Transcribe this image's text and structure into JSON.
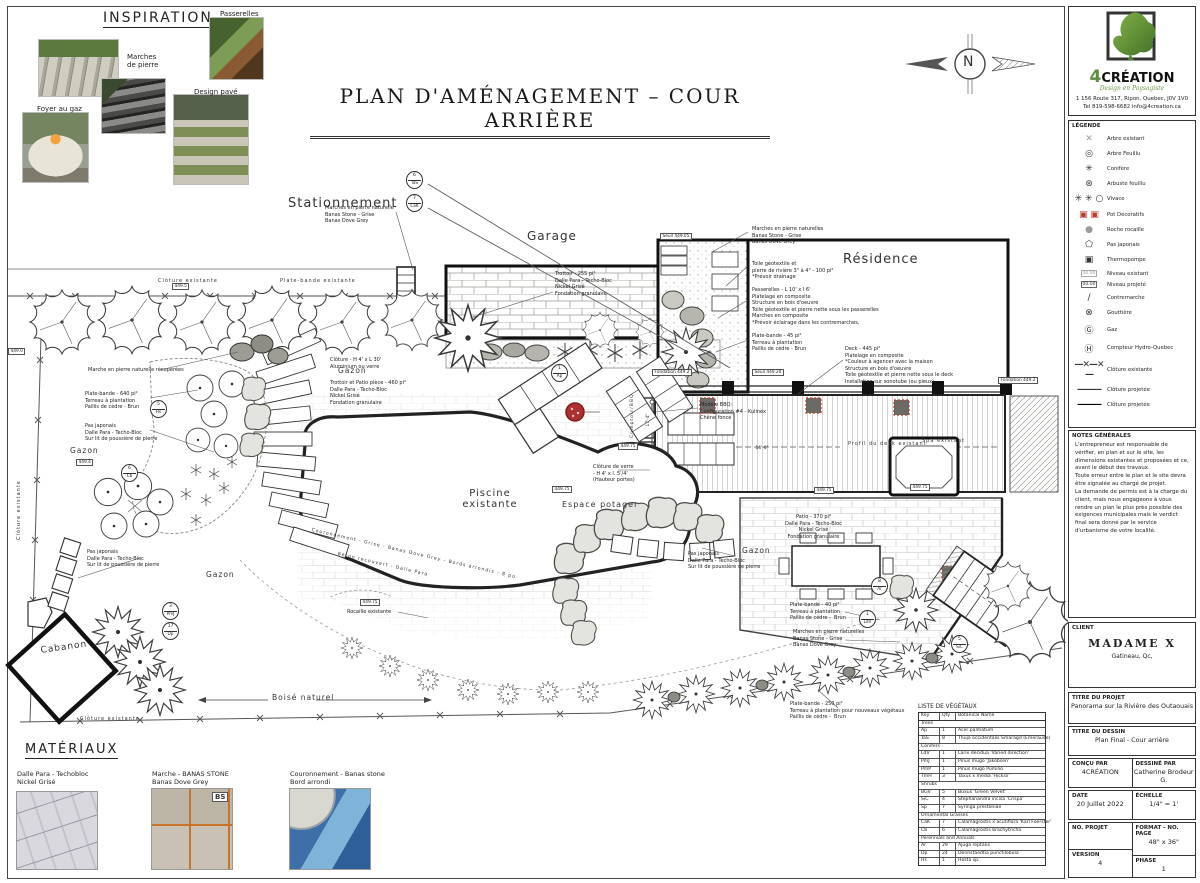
{
  "sheet": {
    "title": "PLAN D'AMÉNAGEMENT – COUR ARRIÈRE",
    "north_letter": "N"
  },
  "inspiration": {
    "title": "INSPIRATION",
    "labels": [
      {
        "t": "Passerelles",
        "x": 220,
        "y": 10
      },
      {
        "t": "Marches\nde pierre",
        "x": 127,
        "y": 53
      },
      {
        "t": "Foyer au gaz",
        "x": 37,
        "y": 105
      },
      {
        "t": "Design pavé",
        "x": 194,
        "y": 88
      }
    ]
  },
  "materials": {
    "title": "MATÉRIAUX",
    "badge": "BS",
    "items": [
      {
        "t": "Dalle Para - Techobloc\nNickel Grisé",
        "x": 17,
        "y": 770
      },
      {
        "t": "Marche - BANAS STONE\nBanas Dove Grey",
        "x": 152,
        "y": 770
      },
      {
        "t": "Couronnement - Banas stone\nBord arrondi",
        "x": 290,
        "y": 770
      }
    ]
  },
  "plan": {
    "labels": [
      {
        "t": "Stationnement",
        "x": 288,
        "y": 196,
        "s": 13
      },
      {
        "t": "Garage",
        "x": 527,
        "y": 229,
        "s": 12
      },
      {
        "t": "Résidence",
        "x": 843,
        "y": 252,
        "s": 13
      },
      {
        "t": "Piscine\nexistante",
        "x": 450,
        "y": 488,
        "s": 10,
        "w": 80,
        "al": "center"
      },
      {
        "t": "Espace potager",
        "x": 562,
        "y": 500,
        "s": 8
      },
      {
        "t": "Cabanon",
        "x": 40,
        "y": 646,
        "s": 9,
        "r": -8
      },
      {
        "t": "Gazon",
        "x": 70,
        "y": 446,
        "s": 7.5
      },
      {
        "t": "Gazon",
        "x": 338,
        "y": 366,
        "s": 7.5
      },
      {
        "t": "Gazon",
        "x": 206,
        "y": 570,
        "s": 7.5
      },
      {
        "t": "Gazon",
        "x": 742,
        "y": 546,
        "s": 7.5
      },
      {
        "t": "Boisé naturel",
        "x": 272,
        "y": 693,
        "s": 7.5
      },
      {
        "t": "N",
        "x": 963,
        "y": 54,
        "s": 14,
        "cls": "serif"
      },
      {
        "t": "Clôture existante",
        "x": 158,
        "y": 278,
        "s": 5
      },
      {
        "t": "Plate-bande existante",
        "x": 280,
        "y": 278,
        "s": 5
      },
      {
        "t": "Clôture existante",
        "x": 16,
        "y": 540,
        "s": 5,
        "r": -90
      },
      {
        "t": "Clôture existante",
        "x": 80,
        "y": 716,
        "s": 5
      },
      {
        "t": "Comptoir/BBQ",
        "x": 630,
        "y": 438,
        "s": 4.6,
        "r": -90
      },
      {
        "t": "Spa existant",
        "x": 922,
        "y": 438,
        "s": 5
      },
      {
        "t": "Profil du deck existant",
        "x": 848,
        "y": 441,
        "s": 5
      },
      {
        "t": "Couronnement - Grise - Banas Dove Grey - Bords arrondis - 8 po",
        "x": 312,
        "y": 528,
        "s": 4.6,
        "r": 13
      },
      {
        "t": "Béton recouvert - Dalle Para",
        "x": 338,
        "y": 552,
        "s": 4.6,
        "r": 13
      }
    ],
    "notes": [
      {
        "t": "Marches en pierre naturelle\nBanas Stone - Grise\nBanas Dove Grey",
        "x": 325,
        "y": 205
      },
      {
        "t": "Marches en pierre naturelles\nBanas Stone - Grise\nBanas Dove Grey",
        "x": 752,
        "y": 226
      },
      {
        "t": "Trottoir - 255 pi²\nDalle Para - Techo-Bloc\nNickel Grisé\nFondation granulaire",
        "x": 555,
        "y": 271
      },
      {
        "t": "Toile géotextile et\npierre de rivière 3\" à 4\" - 100 pi²\n*Prévoir drainage",
        "x": 752,
        "y": 261
      },
      {
        "t": "Passerelles - L 10' x l 6'\nPlatelage en composite\nStructure en bois d'oeuvre\nToile géotextile et pierre nette sous les passerelles\nMarches en composite\n*Prévoir éclairage dans les contremarches,",
        "x": 752,
        "y": 287
      },
      {
        "t": "Plate-bande - 45 pi²\nTerreau à plantation\nPaillis de cèdre - Brun",
        "x": 752,
        "y": 333
      },
      {
        "t": "Deck - 445 pi²\nPlatelage en composite\n*Couleur à agencer avec la maison\nStructure en bois d'oeuvre\nToile géotextile et pierre nette sous le deck\nInstallation sur sonotube (ou pieux)",
        "x": 845,
        "y": 346
      },
      {
        "t": "Marche en pierre naturelle récupérées",
        "x": 88,
        "y": 367
      },
      {
        "t": "Plate-bande - 640 pi²\nTerreau à plantation\nPaillis de cèdre - Brun",
        "x": 85,
        "y": 391
      },
      {
        "t": "Pas japonais\nDalle Para - Techo-Bloc\nSur lit de poussière de pierre",
        "x": 85,
        "y": 423
      },
      {
        "t": "Clôture - H 4' x L 30'\nAluminium ou verre",
        "x": 330,
        "y": 357
      },
      {
        "t": "Trottoir et Patio pièce - 460 pi²\nDalle Para - Techo-Bloc\nNickel Grisé\nFondation granulaire",
        "x": 330,
        "y": 380
      },
      {
        "t": "Clôture de verre\n- H 4' x l. 5'/4'\n(Hauteur portes)",
        "x": 593,
        "y": 464
      },
      {
        "t": "Modèle BBQ:\nConfiguration #4 - Kulinex\nChêne foncé",
        "x": 700,
        "y": 402
      },
      {
        "t": "Patio - 370 pi²\nDalle Para - Techo-Bloc\nNickel Grisé\nFondation granulaire",
        "x": 785,
        "y": 514,
        "al": "center"
      },
      {
        "t": "Pas japonais\nDalle Para - Techo-Bloc\nSur lit de poussière de pierre",
        "x": 688,
        "y": 551
      },
      {
        "t": "Pas japonais\nDalle Para - Techo-Bloc\nSur lit de poussière de pierre",
        "x": 87,
        "y": 549
      },
      {
        "t": "Plate-bande - 40 pi²\nTerreau à plantation\nPaillis de cèdre -  Brun",
        "x": 790,
        "y": 602
      },
      {
        "t": "Marches en pierre naturelles\nBanas Stone - Grise\nBanas Dove Grey",
        "x": 793,
        "y": 629
      },
      {
        "t": "Plate-bande - 250 pi²\nTerreau à plantation pour nouveaux végétaux\nPaillis de cèdre -  Brun",
        "x": 790,
        "y": 701
      },
      {
        "t": "Rocaille existante",
        "x": 347,
        "y": 609
      }
    ],
    "markers": [
      {
        "t": "449.5",
        "x": 172,
        "y": 283
      },
      {
        "t": "449.0",
        "x": 8,
        "y": 348
      },
      {
        "t": "449.4",
        "x": 76,
        "y": 459
      },
      {
        "t": "449.75",
        "x": 360,
        "y": 599
      },
      {
        "t": "Seuil 449.05",
        "x": 660,
        "y": 233
      },
      {
        "t": "Fondation 449.2",
        "x": 652,
        "y": 369
      },
      {
        "t": "Seuil 449.20",
        "x": 752,
        "y": 369
      },
      {
        "t": "Fondation 449.2",
        "x": 998,
        "y": 377
      },
      {
        "t": "449.75",
        "x": 618,
        "y": 443
      },
      {
        "t": "449.75",
        "x": 814,
        "y": 487
      },
      {
        "t": "449.75",
        "x": 910,
        "y": 484
      },
      {
        "t": "449.75",
        "x": 552,
        "y": 486
      },
      {
        "t": "17'-4\"",
        "x": 646,
        "y": 428,
        "r": -90,
        "cls": "nb"
      },
      {
        "t": "14'-6\"",
        "x": 754,
        "y": 446,
        "cls": "nb"
      }
    ],
    "callouts": [
      {
        "qty": "6",
        "key": "TaS",
        "x": 406,
        "y": 171
      },
      {
        "qty": "7",
        "key": "CaK",
        "x": 406,
        "y": 194
      },
      {
        "qty": "5",
        "key": "Hs",
        "x": 150,
        "y": 400
      },
      {
        "qty": "6",
        "key": "Cb",
        "x": 121,
        "y": 464
      },
      {
        "qty": "3",
        "key": "PmJ",
        "x": 162,
        "y": 602
      },
      {
        "qty": "17",
        "key": "Dp",
        "x": 162,
        "y": 622
      },
      {
        "qty": "1",
        "key": "Ap",
        "x": 551,
        "y": 364
      },
      {
        "qty": "8",
        "key": "Ar",
        "x": 871,
        "y": 577
      },
      {
        "qty": "1",
        "key": "LdV",
        "x": 859,
        "y": 610
      },
      {
        "qty": "5",
        "key": "SiC",
        "x": 951,
        "y": 635
      }
    ]
  },
  "veg_list": {
    "title": "LISTE DE VÉGÉTAUX",
    "headers": {
      "key": "Key",
      "qty": "Qty",
      "name": "Botanical Name"
    },
    "rows": [
      {
        "cls": "sec",
        "key": "Trees",
        "qty": "",
        "name": ""
      },
      {
        "key": "Ap",
        "qty": "1",
        "name": "Acer palmatum"
      },
      {
        "key": "TaS",
        "qty": "8",
        "name": "Thuja occidentalis Smaragd (Emeraude)"
      },
      {
        "cls": "sec",
        "key": "Conifers",
        "qty": "",
        "name": ""
      },
      {
        "key": "LdV",
        "qty": "1",
        "name": "Larix decidua 'Varied direction'"
      },
      {
        "key": "PmJ",
        "qty": "1",
        "name": "Pinus mugo 'Jakobsen'"
      },
      {
        "key": "PmP",
        "qty": "1",
        "name": "Pinus mugo Pumilio"
      },
      {
        "key": "TmH",
        "qty": "3",
        "name": "Taxus x media 'Hicksii'"
      },
      {
        "cls": "sec",
        "key": "Shrubs",
        "qty": "",
        "name": ""
      },
      {
        "key": "BGV",
        "qty": "5",
        "name": "Buxus 'Green Velvet'"
      },
      {
        "key": "SiC",
        "qty": "4",
        "name": "Stephanandra incisa 'Crispa'"
      },
      {
        "key": "Sp",
        "qty": "7",
        "name": "Syringa prestoniae"
      },
      {
        "cls": "sec",
        "key": "Ornamental Grasses",
        "qty": "",
        "name": ""
      },
      {
        "key": "CaK",
        "qty": "7",
        "name": "Calamagrostis x acutiflora 'Karl Foerster'"
      },
      {
        "key": "Cb",
        "qty": "6",
        "name": "Calamagrostis brachytricha"
      },
      {
        "cls": "sec",
        "key": "Perennials and Annuals",
        "qty": "",
        "name": ""
      },
      {
        "key": "Ar",
        "qty": "29",
        "name": "Ajuga reptans"
      },
      {
        "key": "Dp",
        "qty": "24",
        "name": "Dennstaedtia punctilobula"
      },
      {
        "key": "Hs",
        "qty": "1",
        "name": "Hosta sp."
      }
    ]
  },
  "sidebar": {
    "logo": {
      "brand_4": "4",
      "brand_rest": "CRÉATION",
      "tagline": "Design en Paysagiste",
      "addr1": "1 156 Route 317, Ripon, Quebec, J0V 1V0",
      "addr2": "Tel 819-598-6682  info@4creation.ca"
    },
    "legend": {
      "title": "LÉGENDE",
      "items": [
        {
          "glyph": "✕",
          "label": "Arbre existant",
          "cls": "gray"
        },
        {
          "glyph": "◎",
          "label": "Arbre Feuillu"
        },
        {
          "glyph": "✳",
          "label": "Conifère"
        },
        {
          "glyph": "⊛",
          "label": "Arbuste feuillu"
        },
        {
          "glyph": "✳ ✳ ○",
          "label": "Vivace"
        },
        {
          "glyph": "▣ ▣",
          "label": "Pot Décoratifs",
          "cls": "red"
        },
        {
          "glyph": "●",
          "label": "Roche rocaille",
          "cls": "gray"
        },
        {
          "glyph": "⬠",
          "label": "Pas japonais"
        },
        {
          "glyph": "▣",
          "label": "Thermopompe"
        },
        {
          "glyph": "00.00",
          "label": "Niveau existant",
          "cls": "gbox",
          "boxed": true
        },
        {
          "glyph": "00.00",
          "label": "Niveau projeté",
          "cls": "box",
          "boxed": true
        },
        {
          "glyph": "∕",
          "label": "Contremarche"
        },
        {
          "glyph": "⊗",
          "label": "Gouttière"
        },
        {
          "glyph": "Ⓖ",
          "label": "Gaz"
        },
        {
          "glyph": "Ⓗ",
          "label": "Compteur Hydro-Quebec"
        },
        {
          "glyph": "—✕—✕—",
          "label": "Clôture existante",
          "cls": "line"
        },
        {
          "glyph": "———",
          "label": "Clôture projetée",
          "cls": "line"
        },
        {
          "glyph": "———",
          "label": "Clôture projetée",
          "cls": "line2"
        }
      ]
    },
    "general_notes": {
      "title": "NOTES GÉNÉRALES",
      "body": "L'entrepreneur est responsable de vérifier, en plan et sur le site, les dimensions existantes et proposées et ce, avant le début des travaux.\nToute erreur entre le plan et le site devra être signalée au chargé de projet.\nLa demande de permis est à la charge du client, mais nous engageons à vous rendre un plan le plus près possible des exigences municipales mais le verdict final sera donné par le service d'urbanisme de votre localité."
    },
    "client": {
      "label": "CLIENT",
      "name": "MADAME X",
      "city": "Gatineau, Qc,"
    },
    "project": {
      "label": "TITRE DU PROJET",
      "value": "Panorama sur la Rivière des Outaouais"
    },
    "drawing": {
      "label": "TITRE DU DESSIN",
      "value": "Plan Final - Cour arrière"
    },
    "concu": {
      "label": "CONÇU PAR",
      "value": "4CRÉATION"
    },
    "dessine": {
      "label": "DESSINÉ PAR",
      "value": "Catherine Brodeur G."
    },
    "date": {
      "label": "DATE",
      "value": "20 Juillet 2022"
    },
    "echelle": {
      "label": "ÉCHELLE",
      "value": "1/4\" = 1'"
    },
    "no_projet": {
      "label": "NO. PROJET",
      "value": ""
    },
    "format": {
      "label": "FORMAT - NO. PAGE",
      "value": "48\" x 36\""
    },
    "version": {
      "label": "VERSION",
      "value": "4"
    },
    "phase": {
      "label": "PHASE",
      "value": "1"
    }
  }
}
